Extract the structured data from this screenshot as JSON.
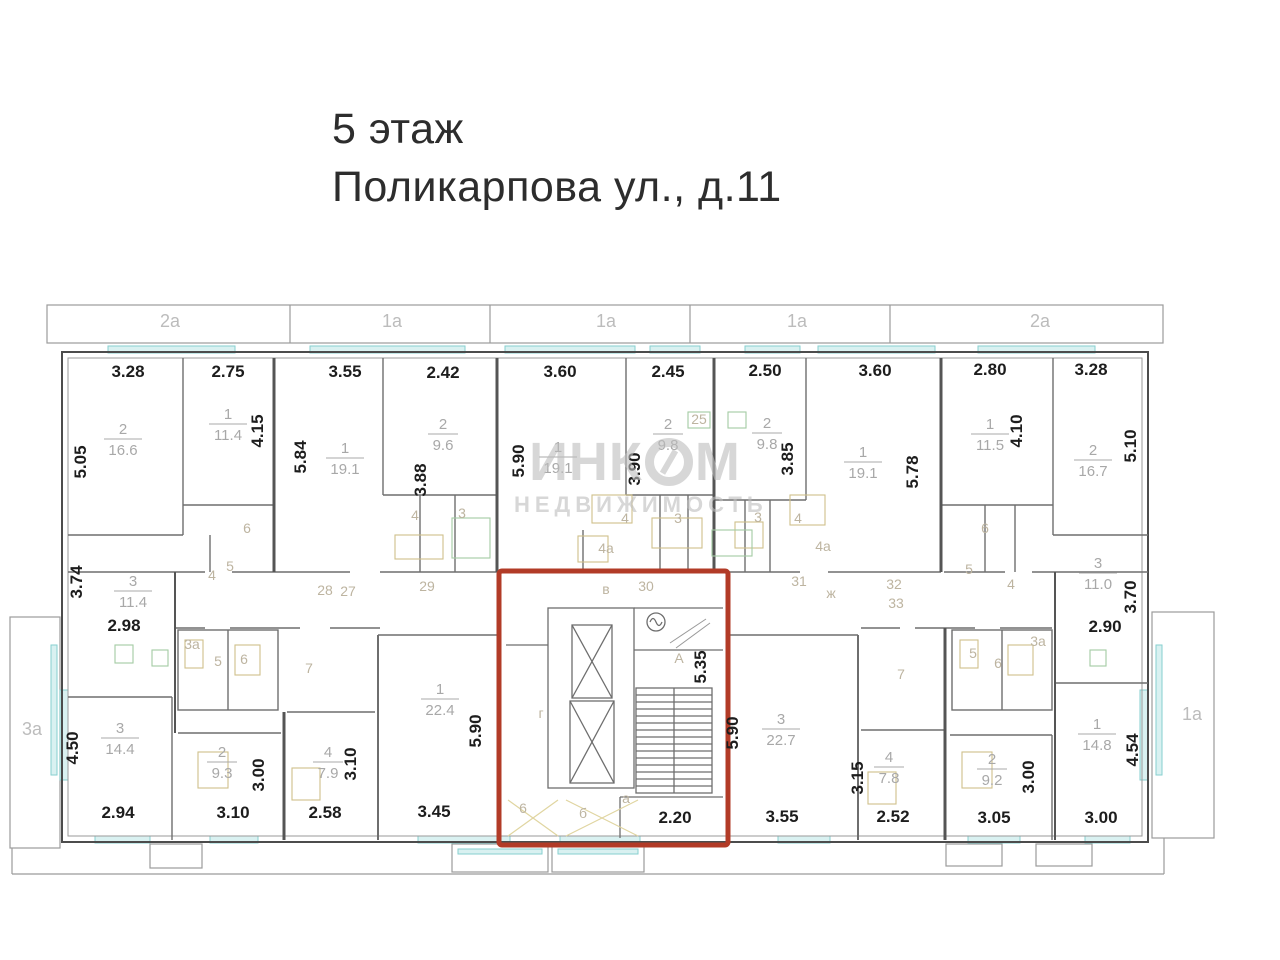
{
  "title": {
    "line1": "5 этаж",
    "line2": "Поликарпова ул., д.11"
  },
  "watermark": {
    "part1": "ИНК",
    "part2": "М",
    "subtitle": "НЕДВИЖИМОСТЬ"
  },
  "colors": {
    "highlight_red": "#b23b27",
    "window_cyan": "#86cfcf",
    "window_cyan_fill": "#d9f1f1",
    "fixture_tan": "#cfc08a",
    "fixture_green": "#a3cba3",
    "wall_gray": "#6e6e6e"
  },
  "plan": {
    "balconies": [
      {
        "t": "2а",
        "x": 170,
        "y": 327
      },
      {
        "t": "1а",
        "x": 392,
        "y": 327
      },
      {
        "t": "1а",
        "x": 606,
        "y": 327
      },
      {
        "t": "1а",
        "x": 797,
        "y": 327
      },
      {
        "t": "2а",
        "x": 1040,
        "y": 327
      },
      {
        "t": "3а",
        "x": 32,
        "y": 735
      },
      {
        "t": "1а",
        "x": 1192,
        "y": 720
      }
    ],
    "dims": [
      {
        "v": "3.28",
        "x": 128,
        "y": 377
      },
      {
        "v": "2.75",
        "x": 228,
        "y": 377
      },
      {
        "v": "3.55",
        "x": 345,
        "y": 377
      },
      {
        "v": "2.42",
        "x": 443,
        "y": 378
      },
      {
        "v": "3.60",
        "x": 560,
        "y": 377
      },
      {
        "v": "2.45",
        "x": 668,
        "y": 377
      },
      {
        "v": "2.50",
        "x": 765,
        "y": 376
      },
      {
        "v": "3.60",
        "x": 875,
        "y": 376
      },
      {
        "v": "2.80",
        "x": 990,
        "y": 375
      },
      {
        "v": "3.28",
        "x": 1091,
        "y": 375
      },
      {
        "v": "5.05",
        "x": 86,
        "y": 462,
        "r": 1
      },
      {
        "v": "4.15",
        "x": 263,
        "y": 431,
        "r": 1
      },
      {
        "v": "5.84",
        "x": 306,
        "y": 457,
        "r": 1
      },
      {
        "v": "3.88",
        "x": 426,
        "y": 480,
        "r": 1
      },
      {
        "v": "5.90",
        "x": 524,
        "y": 461,
        "r": 1
      },
      {
        "v": "3.90",
        "x": 640,
        "y": 469,
        "r": 1
      },
      {
        "v": "3.85",
        "x": 793,
        "y": 459,
        "r": 1
      },
      {
        "v": "5.78",
        "x": 918,
        "y": 472,
        "r": 1
      },
      {
        "v": "4.10",
        "x": 1022,
        "y": 431,
        "r": 1
      },
      {
        "v": "5.10",
        "x": 1136,
        "y": 446,
        "r": 1
      },
      {
        "v": "3.74",
        "x": 82,
        "y": 582,
        "r": 1
      },
      {
        "v": "2.98",
        "x": 124,
        "y": 631
      },
      {
        "v": "2.90",
        "x": 1105,
        "y": 632
      },
      {
        "v": "3.70",
        "x": 1136,
        "y": 597,
        "r": 1
      },
      {
        "v": "5.35",
        "x": 706,
        "y": 667,
        "r": 1
      },
      {
        "v": "5.90",
        "x": 481,
        "y": 731,
        "r": 1
      },
      {
        "v": "5.90",
        "x": 738,
        "y": 733,
        "r": 1
      },
      {
        "v": "2.20",
        "x": 675,
        "y": 823
      },
      {
        "v": "4.50",
        "x": 78,
        "y": 748,
        "r": 1
      },
      {
        "v": "2.94",
        "x": 118,
        "y": 818
      },
      {
        "v": "3.00",
        "x": 264,
        "y": 775,
        "r": 1
      },
      {
        "v": "3.10",
        "x": 233,
        "y": 818
      },
      {
        "v": "3.10",
        "x": 356,
        "y": 764,
        "r": 1
      },
      {
        "v": "2.58",
        "x": 325,
        "y": 818
      },
      {
        "v": "3.45",
        "x": 434,
        "y": 817
      },
      {
        "v": "3.55",
        "x": 782,
        "y": 822
      },
      {
        "v": "3.15",
        "x": 863,
        "y": 778,
        "r": 1
      },
      {
        "v": "2.52",
        "x": 893,
        "y": 822
      },
      {
        "v": "3.05",
        "x": 994,
        "y": 823
      },
      {
        "v": "3.00",
        "x": 1034,
        "y": 777,
        "r": 1
      },
      {
        "v": "3.00",
        "x": 1101,
        "y": 823
      },
      {
        "v": "4.54",
        "x": 1138,
        "y": 750,
        "r": 1
      }
    ],
    "areas": [
      {
        "num": "2",
        "den": "16.6",
        "x": 123,
        "y": 434
      },
      {
        "num": "1",
        "den": "11.4",
        "x": 228,
        "y": 419
      },
      {
        "num": "1",
        "den": "19.1",
        "x": 345,
        "y": 453
      },
      {
        "num": "2",
        "den": "9.6",
        "x": 443,
        "y": 429
      },
      {
        "num": "1",
        "den": "19.1",
        "x": 558,
        "y": 452
      },
      {
        "num": "2",
        "den": "9.8",
        "x": 668,
        "y": 429
      },
      {
        "num": "2",
        "den": "9.8",
        "x": 767,
        "y": 428
      },
      {
        "num": "1",
        "den": "19.1",
        "x": 863,
        "y": 457
      },
      {
        "num": "1",
        "den": "11.5",
        "x": 990,
        "y": 429
      },
      {
        "num": "2",
        "den": "16.7",
        "x": 1093,
        "y": 455
      },
      {
        "num": "3",
        "den": "11.4",
        "x": 133,
        "y": 586
      },
      {
        "num": "3",
        "den": "11.0",
        "x": 1098,
        "y": 568
      },
      {
        "num": "3",
        "den": "14.4",
        "x": 120,
        "y": 733
      },
      {
        "num": "2",
        "den": "9.3",
        "x": 222,
        "y": 757
      },
      {
        "num": "4",
        "den": "7.9",
        "x": 328,
        "y": 757
      },
      {
        "num": "1",
        "den": "22.4",
        "x": 440,
        "y": 694
      },
      {
        "num": "3",
        "den": "22.7",
        "x": 781,
        "y": 724
      },
      {
        "num": "4",
        "den": "7.8",
        "x": 889,
        "y": 762
      },
      {
        "num": "2",
        "den": "9.2",
        "x": 992,
        "y": 764
      },
      {
        "num": "1",
        "den": "14.8",
        "x": 1097,
        "y": 729
      }
    ],
    "faint": [
      {
        "t": "4",
        "x": 415,
        "y": 520
      },
      {
        "t": "3",
        "x": 462,
        "y": 518
      },
      {
        "t": "4",
        "x": 625,
        "y": 523
      },
      {
        "t": "3",
        "x": 678,
        "y": 523
      },
      {
        "t": "3",
        "x": 758,
        "y": 522
      },
      {
        "t": "4",
        "x": 798,
        "y": 523
      },
      {
        "t": "4а",
        "x": 606,
        "y": 553
      },
      {
        "t": "4а",
        "x": 823,
        "y": 551
      },
      {
        "t": "6",
        "x": 247,
        "y": 533
      },
      {
        "t": "6",
        "x": 985,
        "y": 533
      },
      {
        "t": "25",
        "x": 699,
        "y": 424
      },
      {
        "t": "4",
        "x": 212,
        "y": 580
      },
      {
        "t": "5",
        "x": 230,
        "y": 571
      },
      {
        "t": "3а",
        "x": 192,
        "y": 649
      },
      {
        "t": "5",
        "x": 218,
        "y": 666
      },
      {
        "t": "6",
        "x": 244,
        "y": 664
      },
      {
        "t": "7",
        "x": 309,
        "y": 673
      },
      {
        "t": "28",
        "x": 325,
        "y": 595
      },
      {
        "t": "27",
        "x": 348,
        "y": 596
      },
      {
        "t": "29",
        "x": 427,
        "y": 591
      },
      {
        "t": "в",
        "x": 606,
        "y": 594
      },
      {
        "t": "30",
        "x": 646,
        "y": 591
      },
      {
        "t": "31",
        "x": 799,
        "y": 586
      },
      {
        "t": "ж",
        "x": 831,
        "y": 598
      },
      {
        "t": "32",
        "x": 894,
        "y": 589
      },
      {
        "t": "33",
        "x": 896,
        "y": 608
      },
      {
        "t": "5",
        "x": 969,
        "y": 574
      },
      {
        "t": "4",
        "x": 1011,
        "y": 589
      },
      {
        "t": "3а",
        "x": 1038,
        "y": 646
      },
      {
        "t": "5",
        "x": 973,
        "y": 658
      },
      {
        "t": "6",
        "x": 998,
        "y": 668
      },
      {
        "t": "7",
        "x": 901,
        "y": 679
      },
      {
        "t": "г",
        "x": 541,
        "y": 718
      },
      {
        "t": "А",
        "x": 679,
        "y": 663
      },
      {
        "t": "6",
        "x": 523,
        "y": 813
      },
      {
        "t": "б",
        "x": 583,
        "y": 818
      },
      {
        "t": "а",
        "x": 626,
        "y": 803
      }
    ]
  }
}
